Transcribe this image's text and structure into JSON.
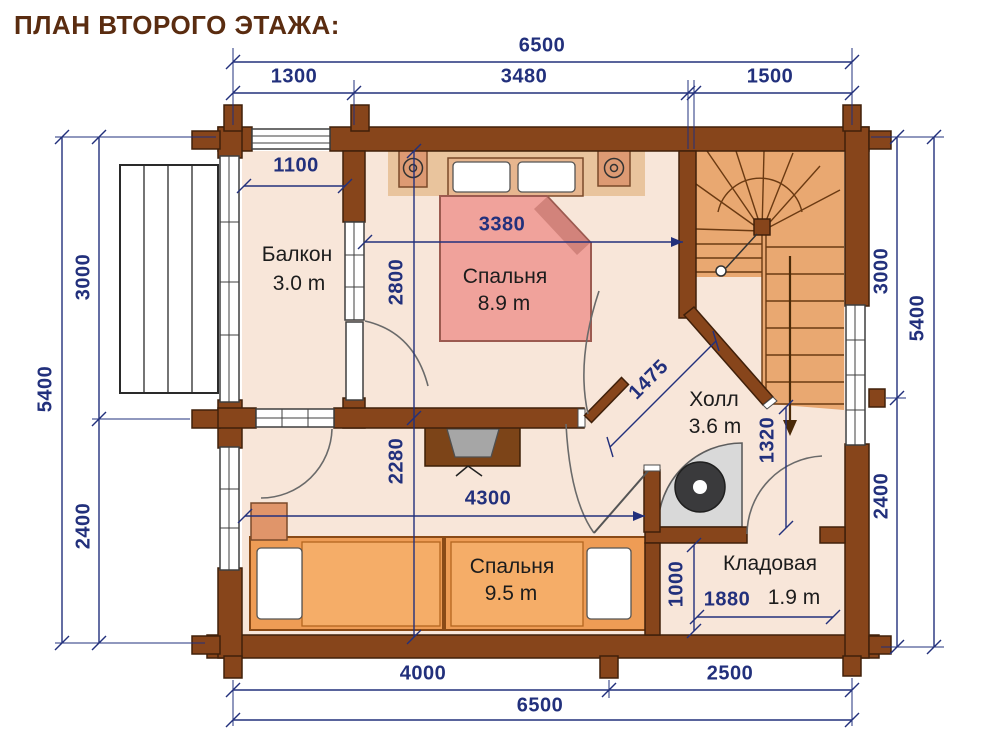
{
  "title": "ПЛАН ВТОРОГО ЭТАЖА:",
  "rooms": {
    "balcony": {
      "name": "Балкон",
      "area": "3.0 m"
    },
    "bedroom_top": {
      "name": "Спальня",
      "area": "8.9 m"
    },
    "hall": {
      "name": "Холл",
      "area": "3.6 m"
    },
    "bedroom_bottom": {
      "name": "Спальня",
      "area": "9.5 m"
    },
    "storage": {
      "name": "Кладовая",
      "area": "1.9 m"
    }
  },
  "dimensions": {
    "top_total": "6500",
    "top_left": "1300",
    "top_mid": "3480",
    "top_right": "1500",
    "left_upper": "3000",
    "left_total": "5400",
    "left_lower": "2400",
    "right_upper": "3000",
    "right_total": "5400",
    "right_lower": "2400",
    "bottom_left": "4000",
    "bottom_right": "2500",
    "bottom_total": "6500",
    "balcony_width": "1100",
    "bed_width": "3380",
    "bedroom_top_depth": "2800",
    "bedroom_bottom_depth": "2280",
    "bedroom_bottom_width": "4300",
    "hall_diagonal": "1475",
    "stair_exit": "1320",
    "storage_depth": "1000",
    "storage_width": "1880"
  },
  "colors": {
    "wall": "#87451b",
    "wallStroke": "#40200a",
    "dim": "#22307c",
    "floor": "#f8e6d9",
    "tanStrip": "#e9c49d",
    "stairs": "#e9a871",
    "bedPink": "#f0a29b",
    "bedPinkFold": "#d2837b",
    "bedPinkBorder": "#9c5a50",
    "bedOrange": "#ee9c55",
    "bedOrangeLight": "#f5ad68",
    "bedOrangeBorder": "#8a4a16",
    "nightstand": "#dd9a73",
    "desk": "#7c4418",
    "chair": "#a6a6a6",
    "fireplaceBody": "#d9d9d9",
    "fireplaceRing": "#3a3a3c"
  }
}
